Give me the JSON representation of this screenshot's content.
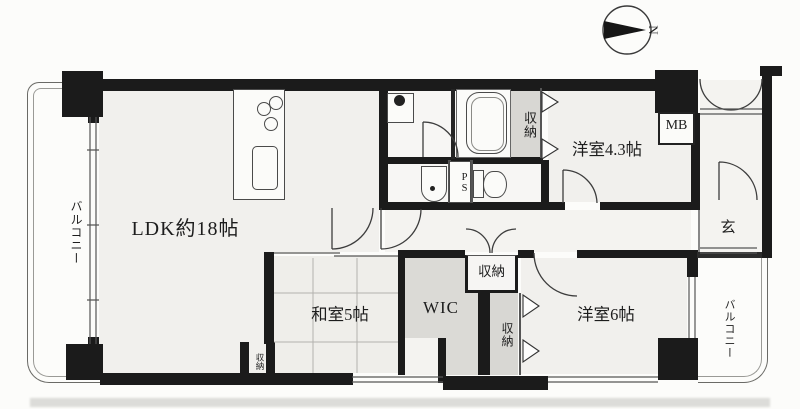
{
  "compass": {
    "north_label": "N"
  },
  "labels": {
    "ldk": "LDK約18帖",
    "japanese_room": "和室5帖",
    "wic": "WIC",
    "western_room_43": "洋室4.3帖",
    "western_room_6": "洋室6帖",
    "entrance": "玄",
    "balcony_left": "バルコニー",
    "balcony_right": "バルコニー",
    "meter_box": "MB",
    "pipe_shaft": "PS",
    "closet_bathroom": "収納",
    "closet_hallway": "収納",
    "closet_bedroom6": "収納",
    "closet_japanese_room": "収納"
  },
  "colors": {
    "wall": "#1b1b1b",
    "room_fill": "#f1f0ed",
    "closet_fill": "#d8d7d3",
    "paper": "#fcfcfa"
  }
}
